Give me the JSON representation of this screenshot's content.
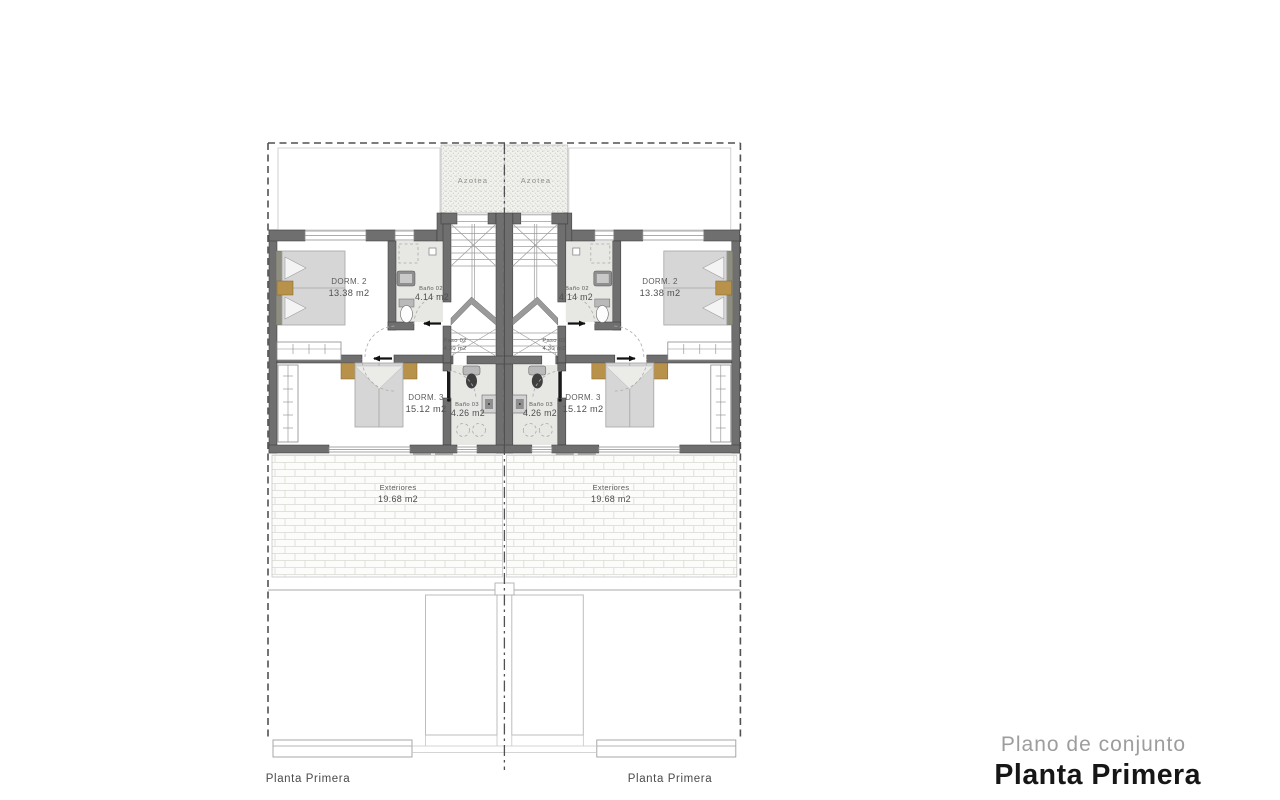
{
  "document": {
    "background": "#ffffff",
    "drawing_type": "architectural floor plan, two mirrored semi-detached units"
  },
  "title_block": {
    "subtitle": "Plano de conjunto",
    "title": "Planta Primera"
  },
  "plan": {
    "floor_label": "Planta Primera",
    "rooms": {
      "azotea": {
        "name": "Azotea"
      },
      "dorm2": {
        "name": "DORM. 2",
        "area": "13.38 m2"
      },
      "bano02": {
        "name": "Baño 02",
        "area": "4.14 m2"
      },
      "paso02": {
        "name": "Paso 02",
        "area": "4.30 m2"
      },
      "dorm3": {
        "name": "DORM. 3",
        "area": "15.12 m2"
      },
      "bano03": {
        "name": "Baño 03",
        "area": "4.26 m2"
      },
      "exteriores": {
        "name": "Exteriores",
        "area": "19.68 m2"
      }
    },
    "colors": {
      "wall": "#6f6f6f",
      "wall_edge": "#3d3d3d",
      "bath_floor": "#e7e7e4",
      "accent_tan": "#b8924a",
      "bed_gray": "#d6d6d6",
      "boundary_line": "#515151",
      "label_text": "#5b5b5b",
      "title_gray": "#9d9d9d",
      "title_dark": "#161616"
    }
  }
}
